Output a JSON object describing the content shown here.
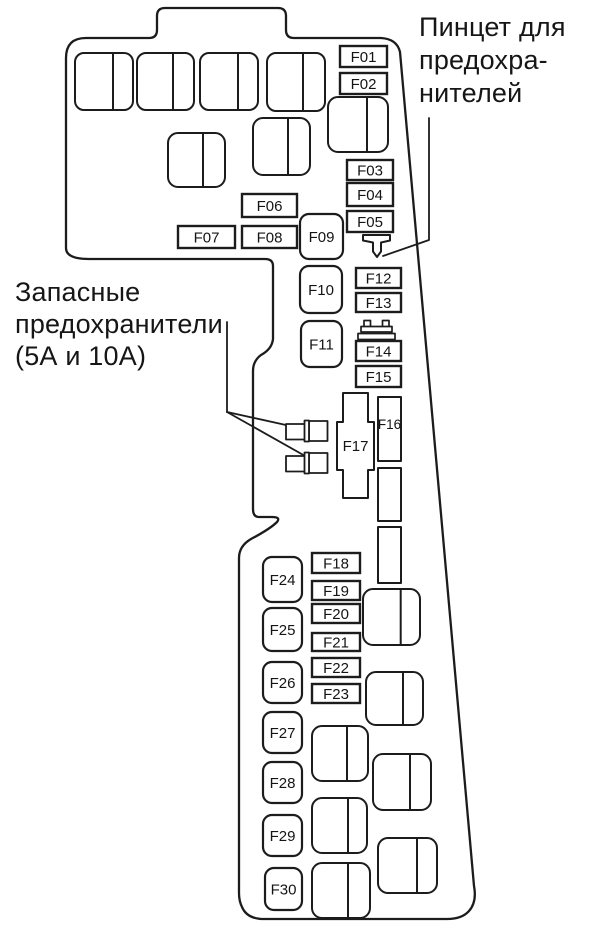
{
  "diagram": {
    "title_context": "fuse-box-layout",
    "background_color": "#ffffff",
    "line_color": "#1c1c1c"
  },
  "annotations": {
    "tweezers": {
      "lines": [
        "Пинцет для",
        "предохра-",
        "нителей"
      ]
    },
    "spare": {
      "lines": [
        "Запасные",
        "предохранители",
        "(5А и 10А)"
      ]
    }
  },
  "icons": {
    "tweezers": "fuse-tweezers-icon",
    "puller": "fuse-puller-icon",
    "spare_holder": "spare-fuse-holder-icon"
  },
  "fuses": {
    "f01": "F01",
    "f02": "F02",
    "f03": "F03",
    "f04": "F04",
    "f05": "F05",
    "f06": "F06",
    "f07": "F07",
    "f08": "F08",
    "f09": "F09",
    "f10": "F10",
    "f11": "F11",
    "f12": "F12",
    "f13": "F13",
    "f14": "F14",
    "f15": "F15",
    "f16": "F16",
    "f17": "F17",
    "f18": "F18",
    "f19": "F19",
    "f20": "F20",
    "f21": "F21",
    "f22": "F22",
    "f23": "F23",
    "f24": "F24",
    "f25": "F25",
    "f26": "F26",
    "f27": "F27",
    "f28": "F28",
    "f29": "F29",
    "f30": "F30"
  }
}
